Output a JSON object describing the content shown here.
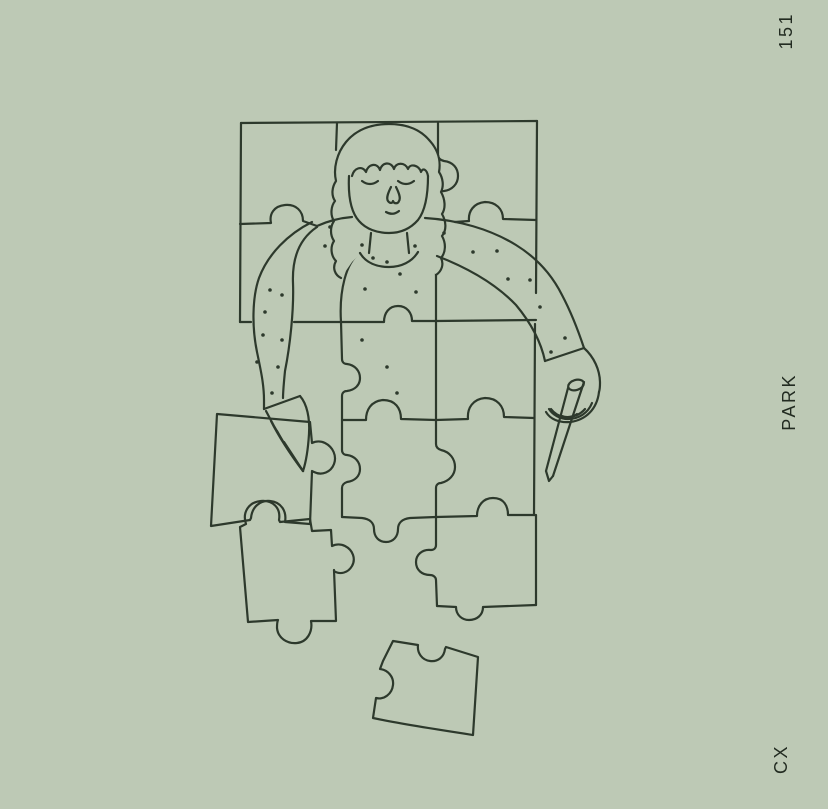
{
  "page": {
    "background_color": "#bdc9b5",
    "line_color": "#2d392c",
    "text_color": "#222b21"
  },
  "margin_texts": {
    "page_number": "151",
    "right_label": "PARK",
    "bottom_label": "CX"
  },
  "illustration": {
    "description": "Single-line sage-green illustration: a woman depicted inside a partly assembled jigsaw puzzle of herself; her freckled sweater arms reach out of the puzzle — the left hand slides a piece into place, the right hand holds a pencil. The top 3x2 block of the puzzle (head and shoulders) is complete; loose pieces lie at the lower left and bottom center."
  }
}
